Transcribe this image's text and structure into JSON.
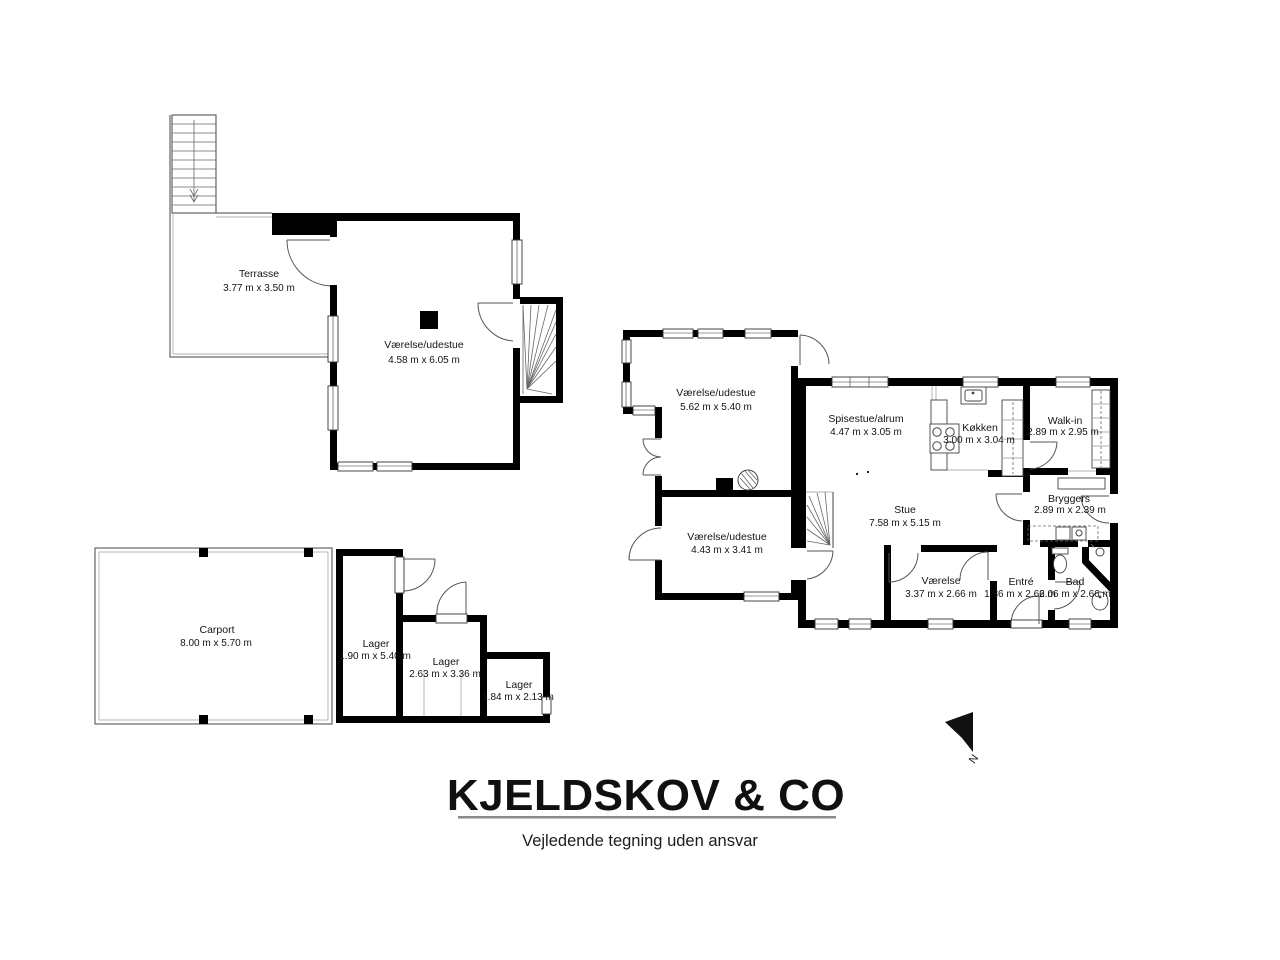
{
  "branding": {
    "company": "KJELDSKOV & CO",
    "disclaimer": "Vejledende tegning uden ansvar"
  },
  "compass": {
    "north_label": "N"
  },
  "plans": {
    "upper_floor": {
      "rooms": {
        "terrasse": {
          "name": "Terrasse",
          "dims": "3.77 m x 3.50 m"
        },
        "vaerelse_udestue": {
          "name": "Værelse/udestue",
          "dims": "4.58 m x 6.05 m"
        }
      }
    },
    "ground_floor": {
      "rooms": {
        "vaerelse_udestue_a": {
          "name": "Værelse/udestue",
          "dims": "5.62 m x 5.40 m"
        },
        "vaerelse_udestue_b": {
          "name": "Værelse/udestue",
          "dims": "4.43 m x 3.41 m"
        },
        "spisestue_alrum": {
          "name": "Spisestue/alrum",
          "dims": "4.47 m x 3.05 m"
        },
        "koekken": {
          "name": "Køkken",
          "dims": "3.00 m x 3.04 m"
        },
        "walk_in": {
          "name": "Walk-in",
          "dims": "2.89 m x 2.95 m"
        },
        "bryggers": {
          "name": "Bryggers",
          "dims": "2.89 m x 2.39 m"
        },
        "stue": {
          "name": "Stue",
          "dims": "7.58 m x 5.15 m"
        },
        "vaerelse": {
          "name": "Værelse",
          "dims": "3.37 m x 2.66 m"
        },
        "entre": {
          "name": "Entré",
          "dims": "1.86 m x 2.66 m"
        },
        "bad": {
          "name": "Bad",
          "dims": "2.06 m x 2.66 m"
        }
      }
    },
    "outbuildings": {
      "rooms": {
        "carport": {
          "name": "Carport",
          "dims": "8.00 m x 5.70 m"
        },
        "lager_1": {
          "name": "Lager",
          "dims": "1.90 m x 5.40 m"
        },
        "lager_2": {
          "name": "Lager",
          "dims": "2.63 m x 3.36 m"
        },
        "lager_3": {
          "name": "Lager",
          "dims": "1.84 m x 2.13 m"
        }
      }
    }
  }
}
